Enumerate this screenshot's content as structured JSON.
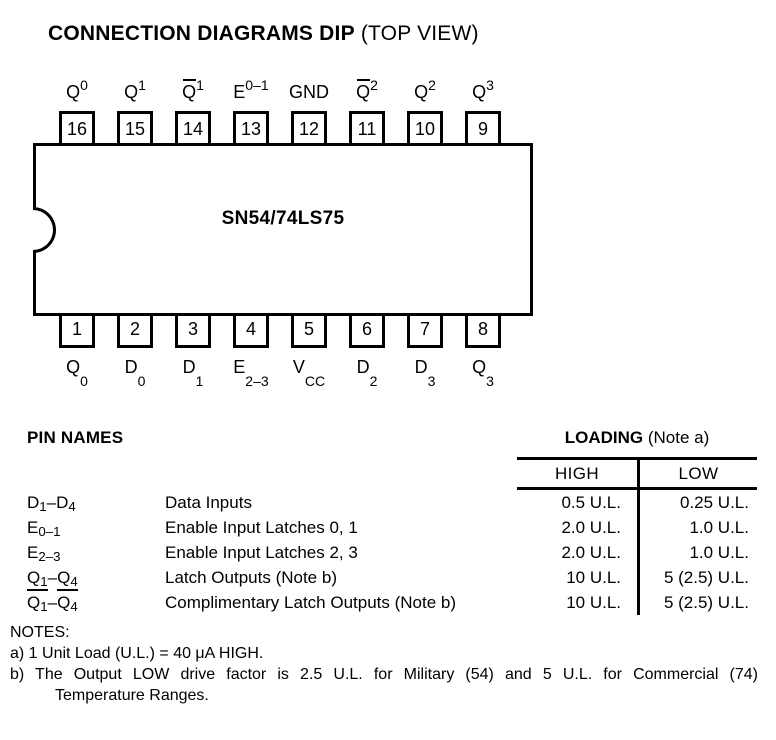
{
  "title": {
    "main": "CONNECTION DIAGRAMS DIP",
    "sub": "(TOP VIEW)"
  },
  "chip": {
    "name": "SN54/74LS75"
  },
  "dip": {
    "top_pins": [
      {
        "number": "16",
        "base": "Q",
        "sub": "0",
        "overline": false
      },
      {
        "number": "15",
        "base": "Q",
        "sub": "1",
        "overline": false
      },
      {
        "number": "14",
        "base": "Q",
        "sub": "1",
        "overline": true
      },
      {
        "number": "13",
        "base": "E",
        "sub": "0–1",
        "overline": false
      },
      {
        "number": "12",
        "base": "GND",
        "sub": "",
        "overline": false
      },
      {
        "number": "11",
        "base": "Q",
        "sub": "2",
        "overline": true
      },
      {
        "number": "10",
        "base": "Q",
        "sub": "2",
        "overline": false
      },
      {
        "number": "9",
        "base": "Q",
        "sub": "3",
        "overline": false
      }
    ],
    "bottom_pins": [
      {
        "number": "1",
        "base": "Q",
        "sub": "0"
      },
      {
        "number": "2",
        "base": "D",
        "sub": "0"
      },
      {
        "number": "3",
        "base": "D",
        "sub": "1"
      },
      {
        "number": "4",
        "base": "E",
        "sub": "2–3"
      },
      {
        "number": "5",
        "base": "V",
        "sub": "CC"
      },
      {
        "number": "6",
        "base": "D",
        "sub": "2"
      },
      {
        "number": "7",
        "base": "D",
        "sub": "3"
      },
      {
        "number": "8",
        "base": "Q",
        "sub": "3"
      }
    ]
  },
  "pin_table": {
    "heading": "PIN NAMES",
    "loading_heading": "LOADING",
    "loading_note": " (Note a)",
    "col_high": "HIGH",
    "col_low": "LOW",
    "rows": [
      {
        "name": {
          "b1": "D",
          "s1": "1",
          "dash": "–",
          "b2": "D",
          "s2": "4"
        },
        "underline": false,
        "description": "Data Inputs",
        "high": "0.5 U.L.",
        "low": "0.25 U.L."
      },
      {
        "name": {
          "b1": "E",
          "s1": "0–1",
          "dash": "",
          "b2": "",
          "s2": ""
        },
        "underline": false,
        "description": "Enable Input Latches 0, 1",
        "high": "2.0 U.L.",
        "low": "1.0 U.L."
      },
      {
        "name": {
          "b1": "E",
          "s1": "2–3",
          "dash": "",
          "b2": "",
          "s2": ""
        },
        "underline": false,
        "description": "Enable Input Latches 2, 3",
        "high": "2.0 U.L.",
        "low": "1.0 U.L."
      },
      {
        "name": {
          "b1": "Q",
          "s1": "1",
          "dash": "–",
          "b2": "Q",
          "s2": "4"
        },
        "underline": true,
        "description": "Latch Outputs (Note b)",
        "high": "10 U.L.",
        "low": "5 (2.5) U.L."
      },
      {
        "name": {
          "b1": "Q",
          "s1": "1",
          "dash": "–",
          "b2": "Q",
          "s2": "4"
        },
        "underline": false,
        "description": "Complimentary Latch Outputs (Note b)",
        "high": "10 U.L.",
        "low": "5 (2.5) U.L."
      }
    ]
  },
  "notes": {
    "heading": "NOTES:",
    "note_a": "a) 1 Unit Load (U.L.) = 40 μA HIGH.",
    "note_b_line1": "b) The Output LOW drive factor is 2.5 U.L. for Military (54) and 5 U.L. for Commercial (74)",
    "note_b_line2": "Temperature Ranges."
  }
}
